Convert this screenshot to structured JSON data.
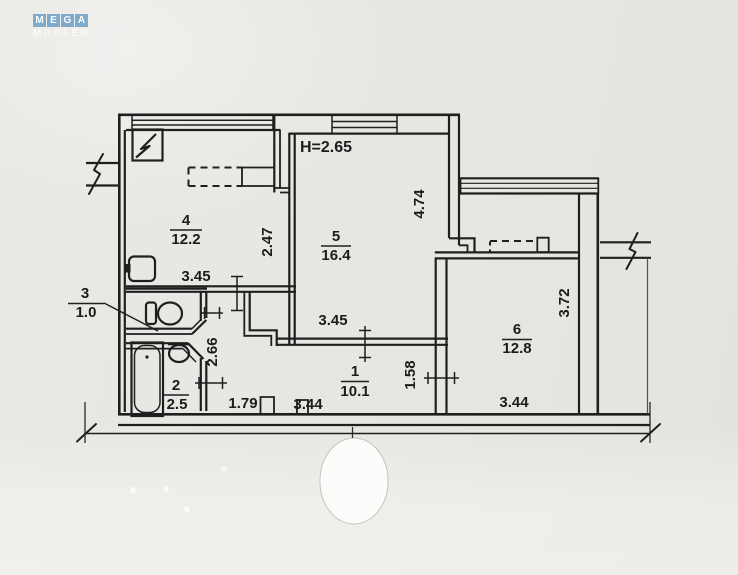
{
  "watermark": {
    "letters": [
      "M",
      "E",
      "G",
      "A"
    ],
    "subtitle": "MAKLER",
    "tile_color": "#80aacb"
  },
  "plan": {
    "height_note": "H=2.65",
    "rooms": [
      {
        "number": "1",
        "area": "10.1"
      },
      {
        "number": "2",
        "area": "2.5"
      },
      {
        "number": "3",
        "area": "1.0"
      },
      {
        "number": "4",
        "area": "12.2"
      },
      {
        "number": "5",
        "area": "16.4"
      },
      {
        "number": "6",
        "area": "12.8"
      }
    ],
    "dims": {
      "kitchen_width": "3.45",
      "kitchen_side": "2.47",
      "living_width": "3.45",
      "living_depth": "4.74",
      "hall_depth": "2.66",
      "hall_left_width": "1.79",
      "hall_width": "3.44",
      "hall_opening": "1.58",
      "room6_width": "3.44",
      "room6_depth": "3.72"
    }
  }
}
